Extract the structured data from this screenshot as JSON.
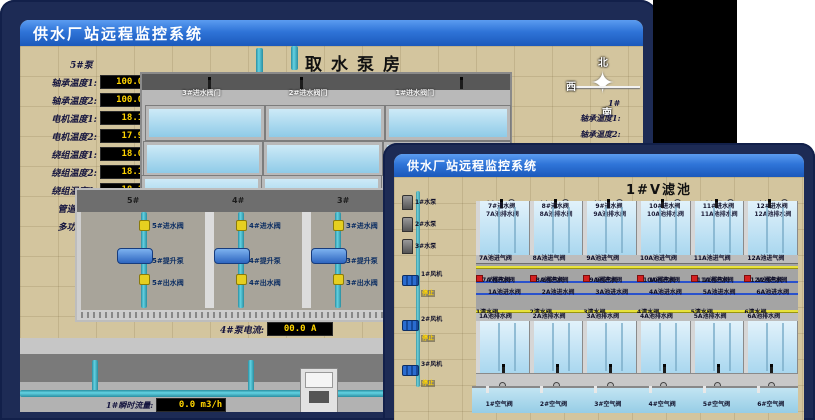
{
  "back": {
    "title_bar": "供水厂站远程监控系统",
    "scene_title": "取水泵房",
    "panel": {
      "pump": "5#泵",
      "rows": [
        {
          "label": "轴承温度1:",
          "value": "100.0°C"
        },
        {
          "label": "轴承温度2:",
          "value": "100.0°C"
        },
        {
          "label": "电机温度1:",
          "value": "18.1°C"
        },
        {
          "label": "电机温度2:",
          "value": "17.9°C"
        },
        {
          "label": "绕组温度1:",
          "value": "18.0°C"
        },
        {
          "label": "绕组温度2:",
          "value": "18.1°C"
        },
        {
          "label": "绕组温度3:",
          "value": "18.1°C"
        },
        {
          "label": "管道压力:",
          "value": "0.0007MPa"
        },
        {
          "label": "多功能阀:",
          "value": "0%"
        }
      ]
    },
    "inlet_gate_valves": [
      "3#进水阀门",
      "2#进水阀门",
      "1#进水阀门"
    ],
    "compass": {
      "n": "北",
      "w": "西",
      "s": "南"
    },
    "right_partial": {
      "pump": "1#",
      "rows": [
        "轴承温度1:",
        "轴承温度2:"
      ]
    },
    "bay_numbers": [
      "5#",
      "4#",
      "3#",
      "2#"
    ],
    "bays": [
      {
        "inlet": "5#进水阀",
        "pump": "5#提升泵",
        "outlet": "5#出水阀"
      },
      {
        "inlet": "4#进水阀",
        "pump": "4#提升泵",
        "outlet": "4#出水阀"
      },
      {
        "inlet": "3#进水阀",
        "pump": "3#提升泵",
        "outlet": "3#出水阀"
      },
      {
        "inlet": "2#进水阀",
        "pump": "2#提升泵",
        "outlet": "2#出水阀"
      }
    ],
    "ammeter_left": {
      "label": "4#泵电流:",
      "value": "00.0 A"
    },
    "ammeter_right": {
      "label": "2#泵电流:",
      "value": "00.0 A"
    },
    "flow_left": {
      "label": "1#瞬时流量:",
      "value": "0.0 m3/h"
    },
    "flow_right": {
      "label": "1#瞬时流量:",
      "value": "0.0 m3/h"
    }
  },
  "front": {
    "title_bar": "供水厂站远程监控系统",
    "scene_title": "1#V滤池",
    "left_pumps": [
      "1#水泵",
      "2#水泵",
      "3#水泵"
    ],
    "left_fans": [
      {
        "name": "1#风机",
        "status": "停止"
      },
      {
        "name": "2#风机",
        "status": "停止"
      },
      {
        "name": "3#风机",
        "status": "停止"
      }
    ],
    "top_cells": [
      {
        "air": "7#空气阀",
        "inlet": "7#进水阀",
        "drain": "7A池排水阀",
        "air_in": "7A池进气阀",
        "exhaust": "7排气阀",
        "pool_inlet": "7A池进水阀"
      },
      {
        "air": "8#空气阀",
        "inlet": "8#进水阀",
        "drain": "8A池排水阀",
        "air_in": "8A池进气阀",
        "exhaust": "8排气阀",
        "pool_inlet": "8A池进水阀"
      },
      {
        "air": "9#空气阀",
        "inlet": "9#进水阀",
        "drain": "9A池排水阀",
        "air_in": "9A池进气阀",
        "exhaust": "9排气阀",
        "pool_inlet": "9A池进水阀"
      },
      {
        "air": "10#空气阀",
        "inlet": "10#进水阀",
        "drain": "10A池排水阀",
        "air_in": "10A池进气阀",
        "exhaust": "10排气阀",
        "pool_inlet": "10A池进水阀"
      },
      {
        "air": "11#空气阀",
        "inlet": "11#进水阀",
        "drain": "11A池排水阀",
        "air_in": "11A池进气阀",
        "exhaust": "11排气阀",
        "pool_inlet": "11A池进水阀"
      },
      {
        "air": "12#空气阀",
        "inlet": "12#进水阀",
        "drain": "12A池排水阀",
        "air_in": "12A池进气阀",
        "exhaust": "12排气阀",
        "pool_inlet": "12A池进水阀"
      }
    ],
    "bottom_cells": [
      {
        "air": "1#空气阀",
        "inlet": "1进水阀",
        "drain": "1A池排水阀",
        "air_in": "1A池进气阀",
        "exhaust": "1排气阀",
        "pool_inlet": "1A池进水阀",
        "clean": "1清水阀"
      },
      {
        "air": "2#空气阀",
        "inlet": "2进水阀",
        "drain": "2A池排水阀",
        "air_in": "2A池进气阀",
        "exhaust": "2排气阀",
        "pool_inlet": "2A池进水阀",
        "clean": "2清水阀"
      },
      {
        "air": "3#空气阀",
        "inlet": "3进水阀",
        "drain": "3A池排水阀",
        "air_in": "3A池进气阀",
        "exhaust": "3排气阀",
        "pool_inlet": "3A池进水阀",
        "clean": "3清水阀"
      },
      {
        "air": "4#空气阀",
        "inlet": "4进水阀",
        "drain": "4A池排水阀",
        "air_in": "4A池进气阀",
        "exhaust": "4排气阀",
        "pool_inlet": "4A池进水阀",
        "clean": "4清水阀"
      },
      {
        "air": "5#空气阀",
        "inlet": "5进水阀",
        "drain": "5A池排水阀",
        "air_in": "5A池进气阀",
        "exhaust": "5排气阀",
        "pool_inlet": "5A池进水阀",
        "clean": "5清水阀"
      },
      {
        "air": "6#空气阀",
        "inlet": "6进水阀",
        "drain": "6A池排水阀",
        "air_in": "6A池进气阀",
        "exhaust": "6排气阀",
        "pool_inlet": "6A池进水阀",
        "clean": "6清水阀"
      }
    ]
  }
}
